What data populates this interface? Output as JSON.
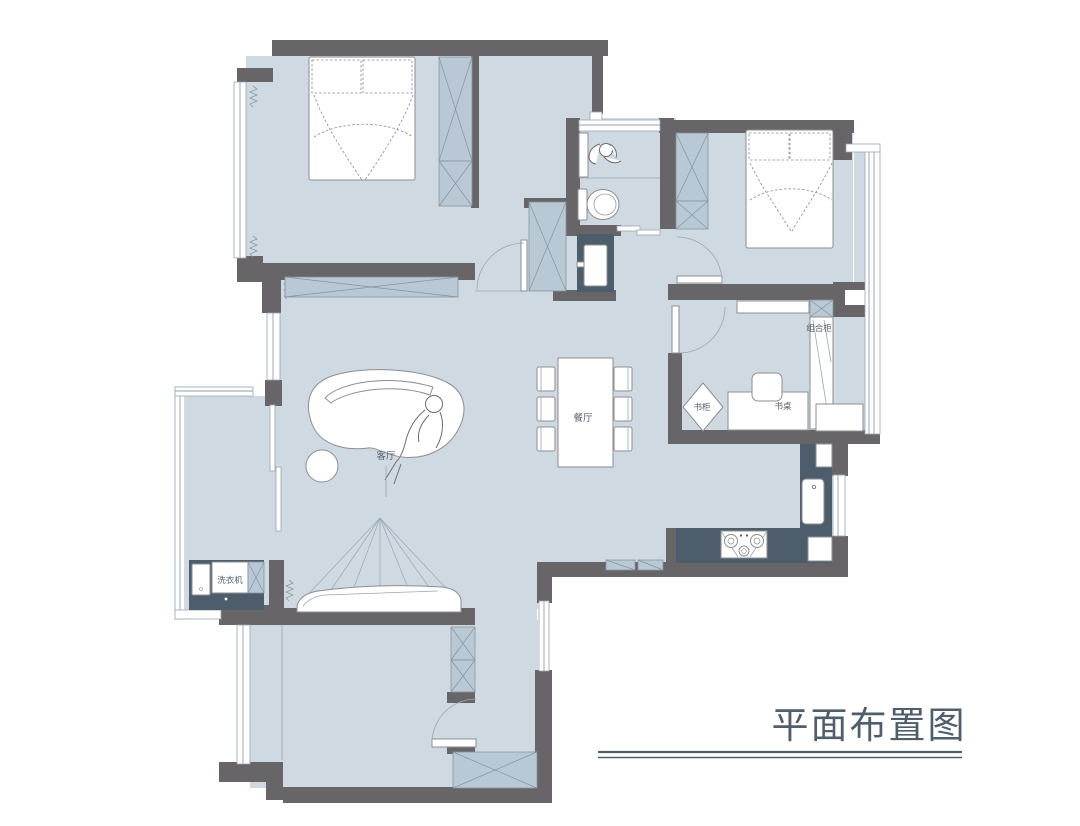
{
  "title": {
    "text": "平面布置图"
  },
  "labels": {
    "living_room": "客厅",
    "dining_room": "餐厅",
    "bookcase": "书柜",
    "desk": "书桌",
    "combo_cabinet": "组合柜",
    "washing_machine": "洗衣机"
  },
  "colors": {
    "floor": "#cfd9e2",
    "wall": "#686568",
    "cabinet": "#b8c8d5",
    "cabinet_line": "#8694a1",
    "counter": "#4d5d6b",
    "furniture_line": "#8e8e91",
    "thin_line": "#9aa6b1",
    "label": "#5a6470",
    "title": "#505e6b"
  }
}
